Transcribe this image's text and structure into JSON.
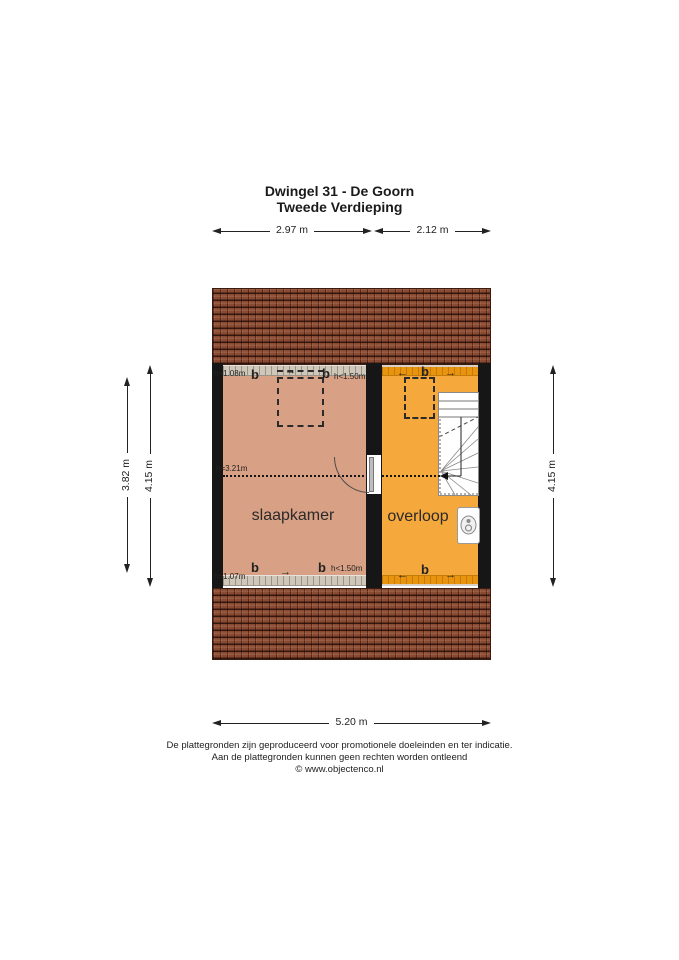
{
  "title": {
    "line1": "Dwingel 31 - De Goorn",
    "line2": "Tweede Verdieping"
  },
  "dimensions": {
    "top_left": "2.97 m",
    "top_right": "2.12 m",
    "left_inner": "3.82 m",
    "left_outer": "4.15 m",
    "right": "4.15 m",
    "bottom": "5.20 m"
  },
  "rooms": {
    "bedroom": {
      "label": "slaapkamer"
    },
    "landing": {
      "label": "overloop"
    }
  },
  "annotations": {
    "window_label": "b",
    "height_top_left": "h=1.08m",
    "height_top_right": "h<1.50m",
    "height_mid": "h=3.21m",
    "height_bottom_left": "h=1.07m",
    "height_bottom_right": "h<1.50m"
  },
  "icons": {
    "arrow_right": "→",
    "arrow_left": "←"
  },
  "footer": {
    "line1": "De plattegronden zijn geproduceerd voor promotionele doeleinden en ter indicatie.",
    "line2": "Aan de plattegronden kunnen geen rechten worden ontleend",
    "line3": "© www.objectenco.nl"
  },
  "colors": {
    "bedroom_fill": "#d8a084",
    "landing_fill": "#f5a83b",
    "band_gray": "#cfc7ba",
    "band_orange": "#e8940f",
    "roof_base": "#8a4a31",
    "wall": "#161616"
  }
}
